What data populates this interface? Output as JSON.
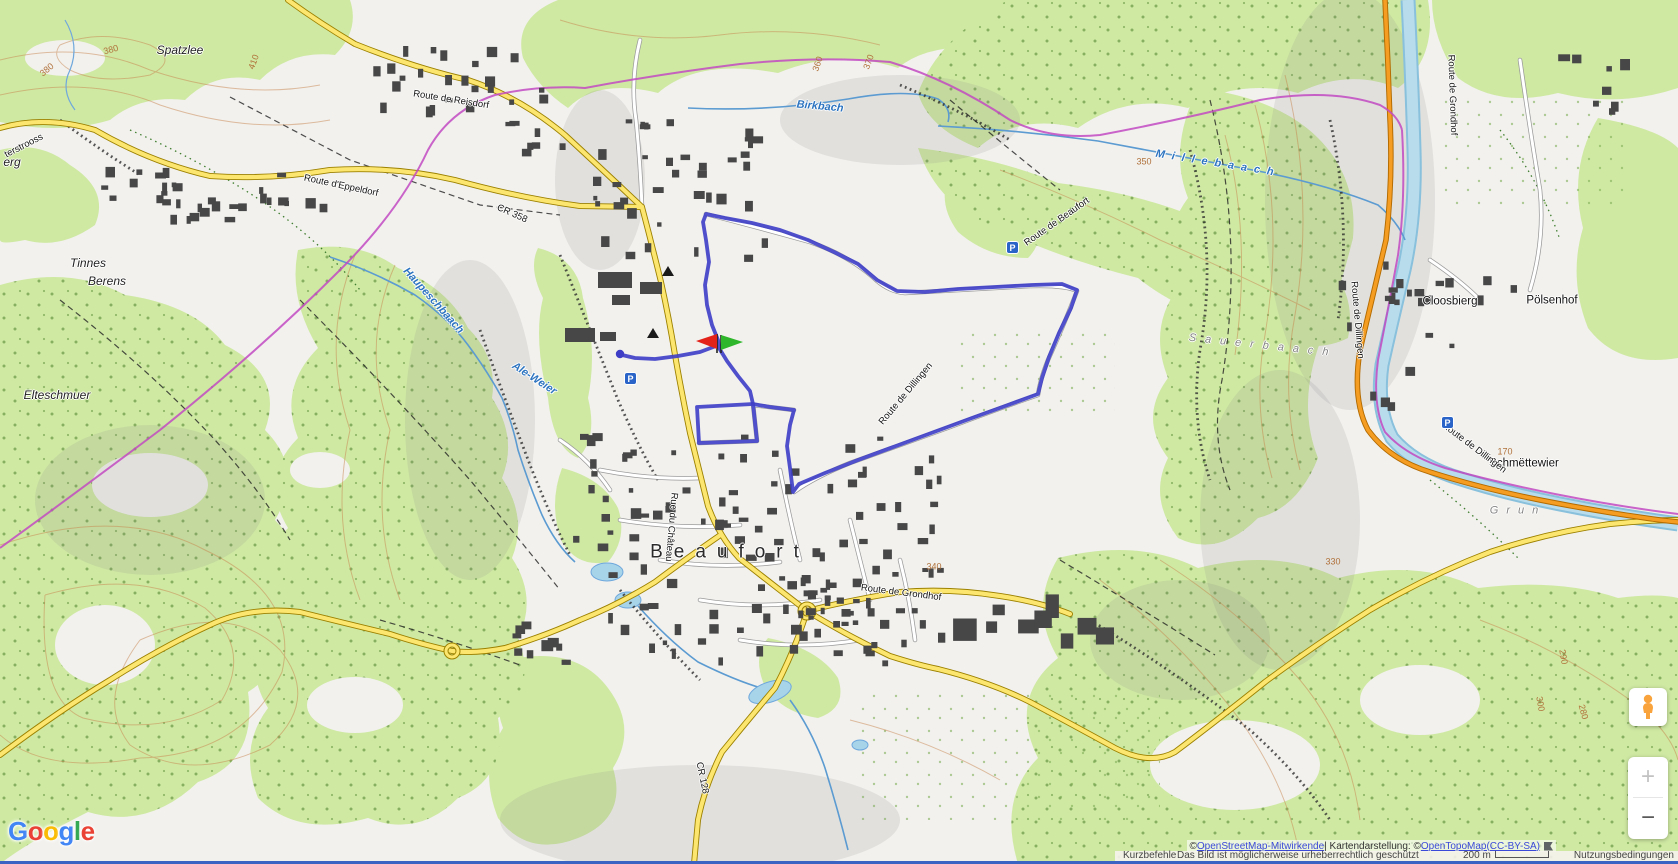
{
  "map": {
    "labels": [
      {
        "t": "Spatzlee",
        "x": 180,
        "y": 50,
        "c": "loc"
      },
      {
        "t": "Tinnes",
        "x": 88,
        "y": 263,
        "c": "loc"
      },
      {
        "t": "Berens",
        "x": 107,
        "y": 281,
        "c": "loc"
      },
      {
        "t": "Elteschmuer",
        "x": 57,
        "y": 395,
        "c": "loc"
      },
      {
        "t": "erg",
        "x": 12,
        "y": 162,
        "c": "loc"
      },
      {
        "t": "Cloosbierg",
        "x": 1450,
        "y": 302,
        "c": "vil"
      },
      {
        "t": "Pölsenhof",
        "x": 1552,
        "y": 301,
        "c": "vil"
      },
      {
        "t": "Schmëttewier",
        "x": 1524,
        "y": 464,
        "c": "vil"
      },
      {
        "t": "Beaufort",
        "x": 730,
        "y": 552,
        "c": "town",
        "ls": 11,
        "fs": 19
      },
      {
        "t": "Grun",
        "x": 1518,
        "y": 511,
        "c": "area",
        "ls": 8
      },
      {
        "t": "Sauerbaach",
        "x": 1263,
        "y": 346,
        "c": "area",
        "r": 6,
        "ls": 9
      },
      {
        "t": "Birkbach",
        "x": 820,
        "y": 107,
        "c": "water",
        "r": 5
      },
      {
        "t": "Millebaach",
        "x": 1218,
        "y": 164,
        "c": "water",
        "r": 9,
        "ls": 7
      },
      {
        "t": "Haupeschbaach",
        "x": 433,
        "y": 301,
        "c": "water",
        "r": 48
      },
      {
        "t": "Ale-Weier",
        "x": 534,
        "y": 379,
        "c": "water",
        "r": 33
      },
      {
        "t": "Route de Reisdorf",
        "x": 451,
        "y": 100,
        "c": "road",
        "r": 9
      },
      {
        "t": "Route d'Eppeldorf",
        "x": 341,
        "y": 186,
        "c": "road",
        "r": 12
      },
      {
        "t": "CR 358",
        "x": 512,
        "y": 214,
        "c": "road",
        "r": 24
      },
      {
        "t": "Route de Beaufort",
        "x": 1057,
        "y": 222,
        "c": "road",
        "r": -35
      },
      {
        "t": "Route de Dillingen",
        "x": 906,
        "y": 394,
        "c": "road",
        "r": -50
      },
      {
        "t": "Route de Grondhof",
        "x": 901,
        "y": 593,
        "c": "road",
        "r": 7
      },
      {
        "t": "Route de Dillingen",
        "x": 1474,
        "y": 448,
        "c": "road",
        "r": 37
      },
      {
        "t": "Route de Grondhof",
        "x": 1452,
        "y": 95,
        "c": "road",
        "r": 88
      },
      {
        "t": "Route de Dillingen",
        "x": 1357,
        "y": 320,
        "c": "road",
        "r": 85
      },
      {
        "t": "Rue du Château",
        "x": 671,
        "y": 527,
        "c": "road",
        "r": 95
      },
      {
        "t": "CR 128",
        "x": 702,
        "y": 778,
        "c": "road",
        "r": 78
      },
      {
        "t": "terstrooss",
        "x": 24,
        "y": 146,
        "c": "road",
        "r": -27
      },
      {
        "t": "380",
        "x": 47,
        "y": 70,
        "c": "ctr",
        "r": -40
      },
      {
        "t": "380",
        "x": 111,
        "y": 50,
        "c": "ctr",
        "r": -15
      },
      {
        "t": "410",
        "x": 254,
        "y": 62,
        "c": "ctr",
        "r": -70
      },
      {
        "t": "360",
        "x": 818,
        "y": 64,
        "c": "ctr",
        "r": -72
      },
      {
        "t": "370",
        "x": 869,
        "y": 62,
        "c": "ctr",
        "r": -70
      },
      {
        "t": "350",
        "x": 1144,
        "y": 162,
        "c": "ctr"
      },
      {
        "t": "340",
        "x": 934,
        "y": 567,
        "c": "ctr"
      },
      {
        "t": "330",
        "x": 1333,
        "y": 562,
        "c": "ctr"
      },
      {
        "t": "290",
        "x": 1563,
        "y": 657,
        "c": "ctr",
        "r": 80
      },
      {
        "t": "300",
        "x": 1540,
        "y": 704,
        "c": "ctr",
        "r": 80
      },
      {
        "t": "280",
        "x": 1583,
        "y": 712,
        "c": "ctr",
        "r": 75
      },
      {
        "t": "170",
        "x": 1505,
        "y": 452,
        "c": "ctr"
      }
    ],
    "parking_glyph": "P",
    "parking_icons": [
      {
        "x": 1012,
        "y": 247
      },
      {
        "x": 1447,
        "y": 422
      },
      {
        "x": 630,
        "y": 378
      }
    ]
  },
  "route": {
    "color": "#3d3dc6",
    "flag_red": "#e32219",
    "flag_green": "#2fb62a"
  },
  "controls": {
    "zoom_in_label": "+",
    "zoom_out_label": "−"
  },
  "attribution": {
    "line1_prefix": "© ",
    "link_osm": "OpenStreetMap-Mitwirkende",
    "line1_mid": " | Kartendarstellung: © ",
    "link_otm": "OpenTopoMap",
    "line1_sep": " ",
    "link_license": "(CC-BY-SA)",
    "shortcuts": "Kurzbefehle",
    "copyright_notice": "Das Bild ist möglicherweise urheberrechtlich geschützt",
    "scale_text": "200 m",
    "terms": "Nutzungsbedingungen"
  },
  "logo": {
    "letters": [
      {
        "ch": "G",
        "color": "#4285F4"
      },
      {
        "ch": "o",
        "color": "#EA4335"
      },
      {
        "ch": "o",
        "color": "#FBBC05"
      },
      {
        "ch": "g",
        "color": "#4285F4"
      },
      {
        "ch": "l",
        "color": "#34A853"
      },
      {
        "ch": "e",
        "color": "#EA4335"
      }
    ]
  }
}
